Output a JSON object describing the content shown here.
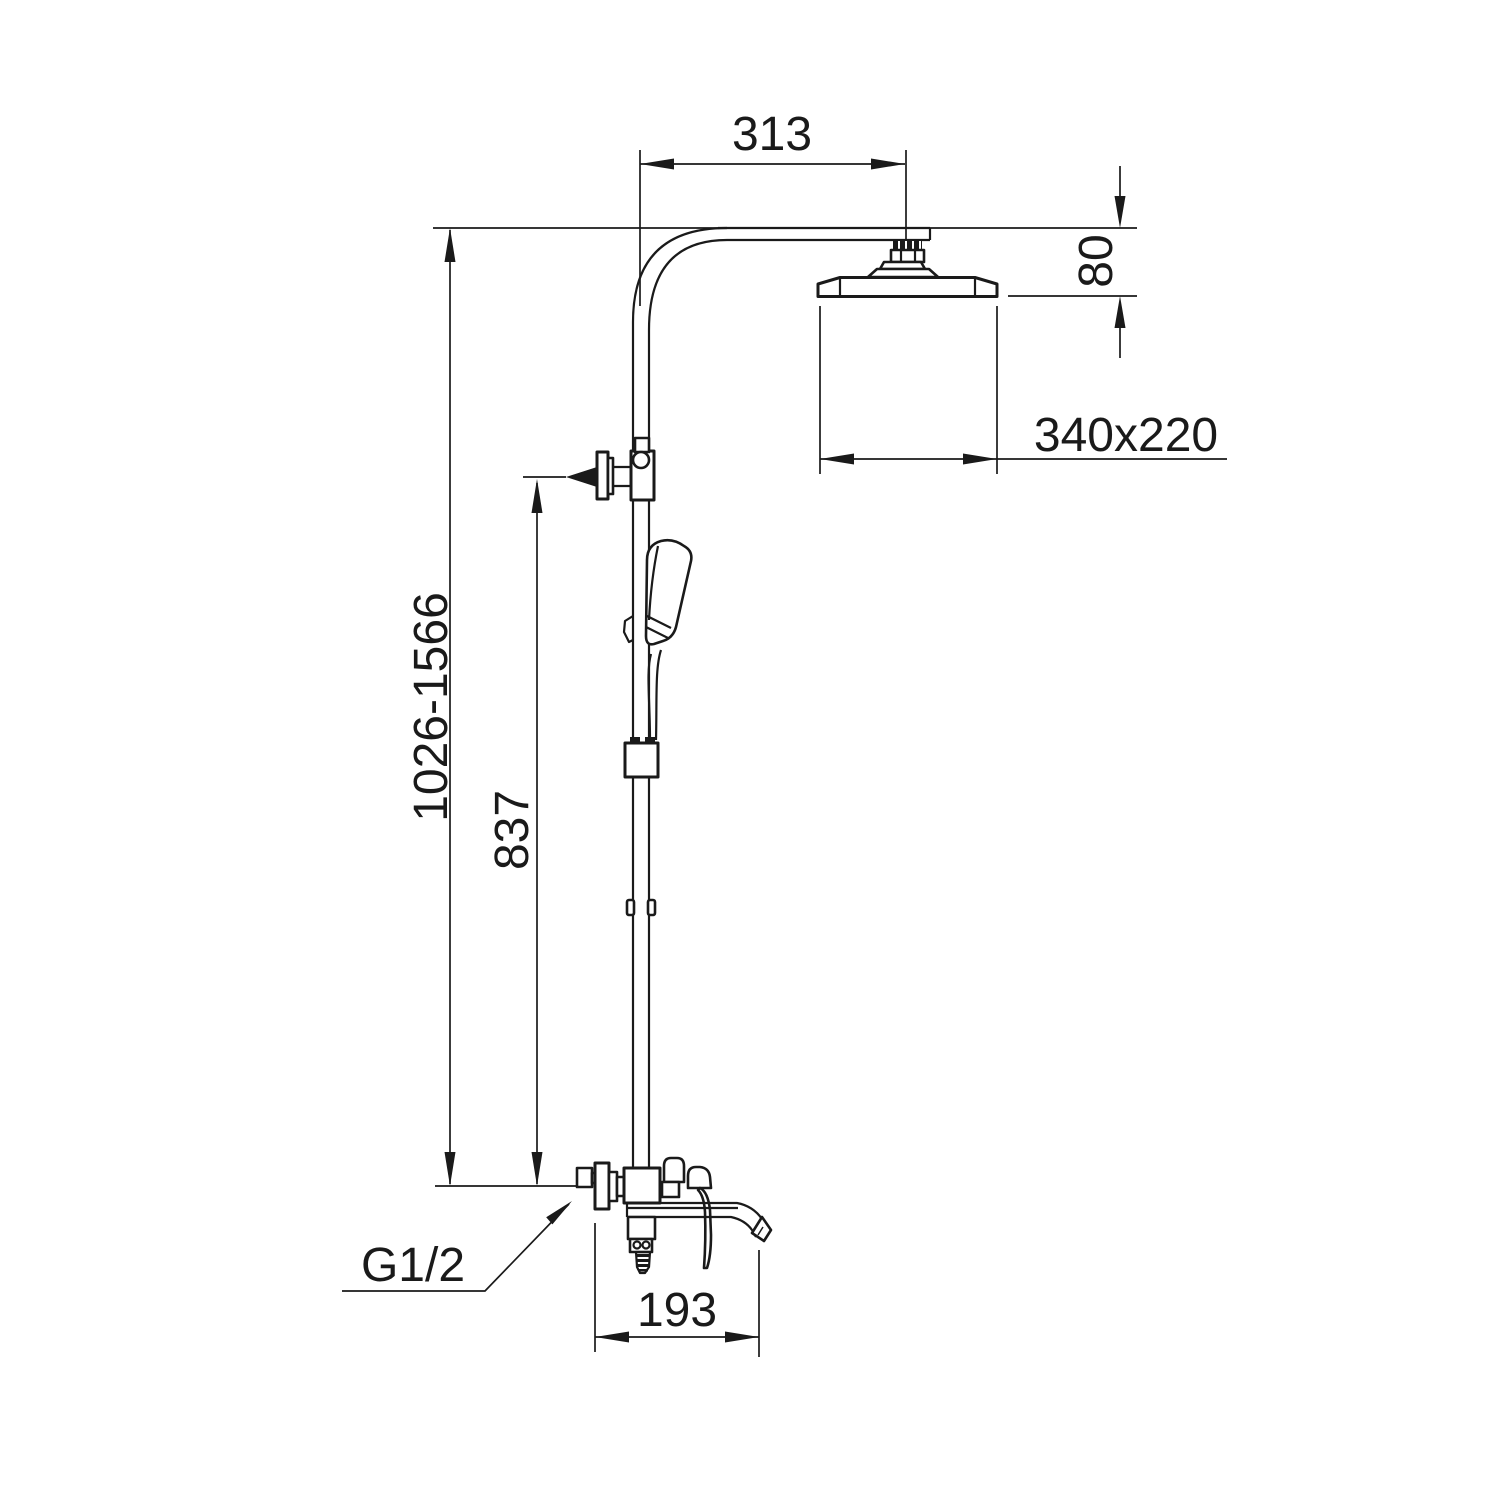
{
  "drawing": {
    "title": "shower-column-dimension-drawing",
    "labels": {
      "arm_offset": "313",
      "head_drop": "80",
      "head_size": "340x220",
      "height_range": "1026-1566",
      "bracket_height": "837",
      "spout_reach": "193",
      "thread": "G1/2"
    },
    "colors": {
      "line": "#1a1a1a",
      "background": "#ffffff"
    }
  }
}
